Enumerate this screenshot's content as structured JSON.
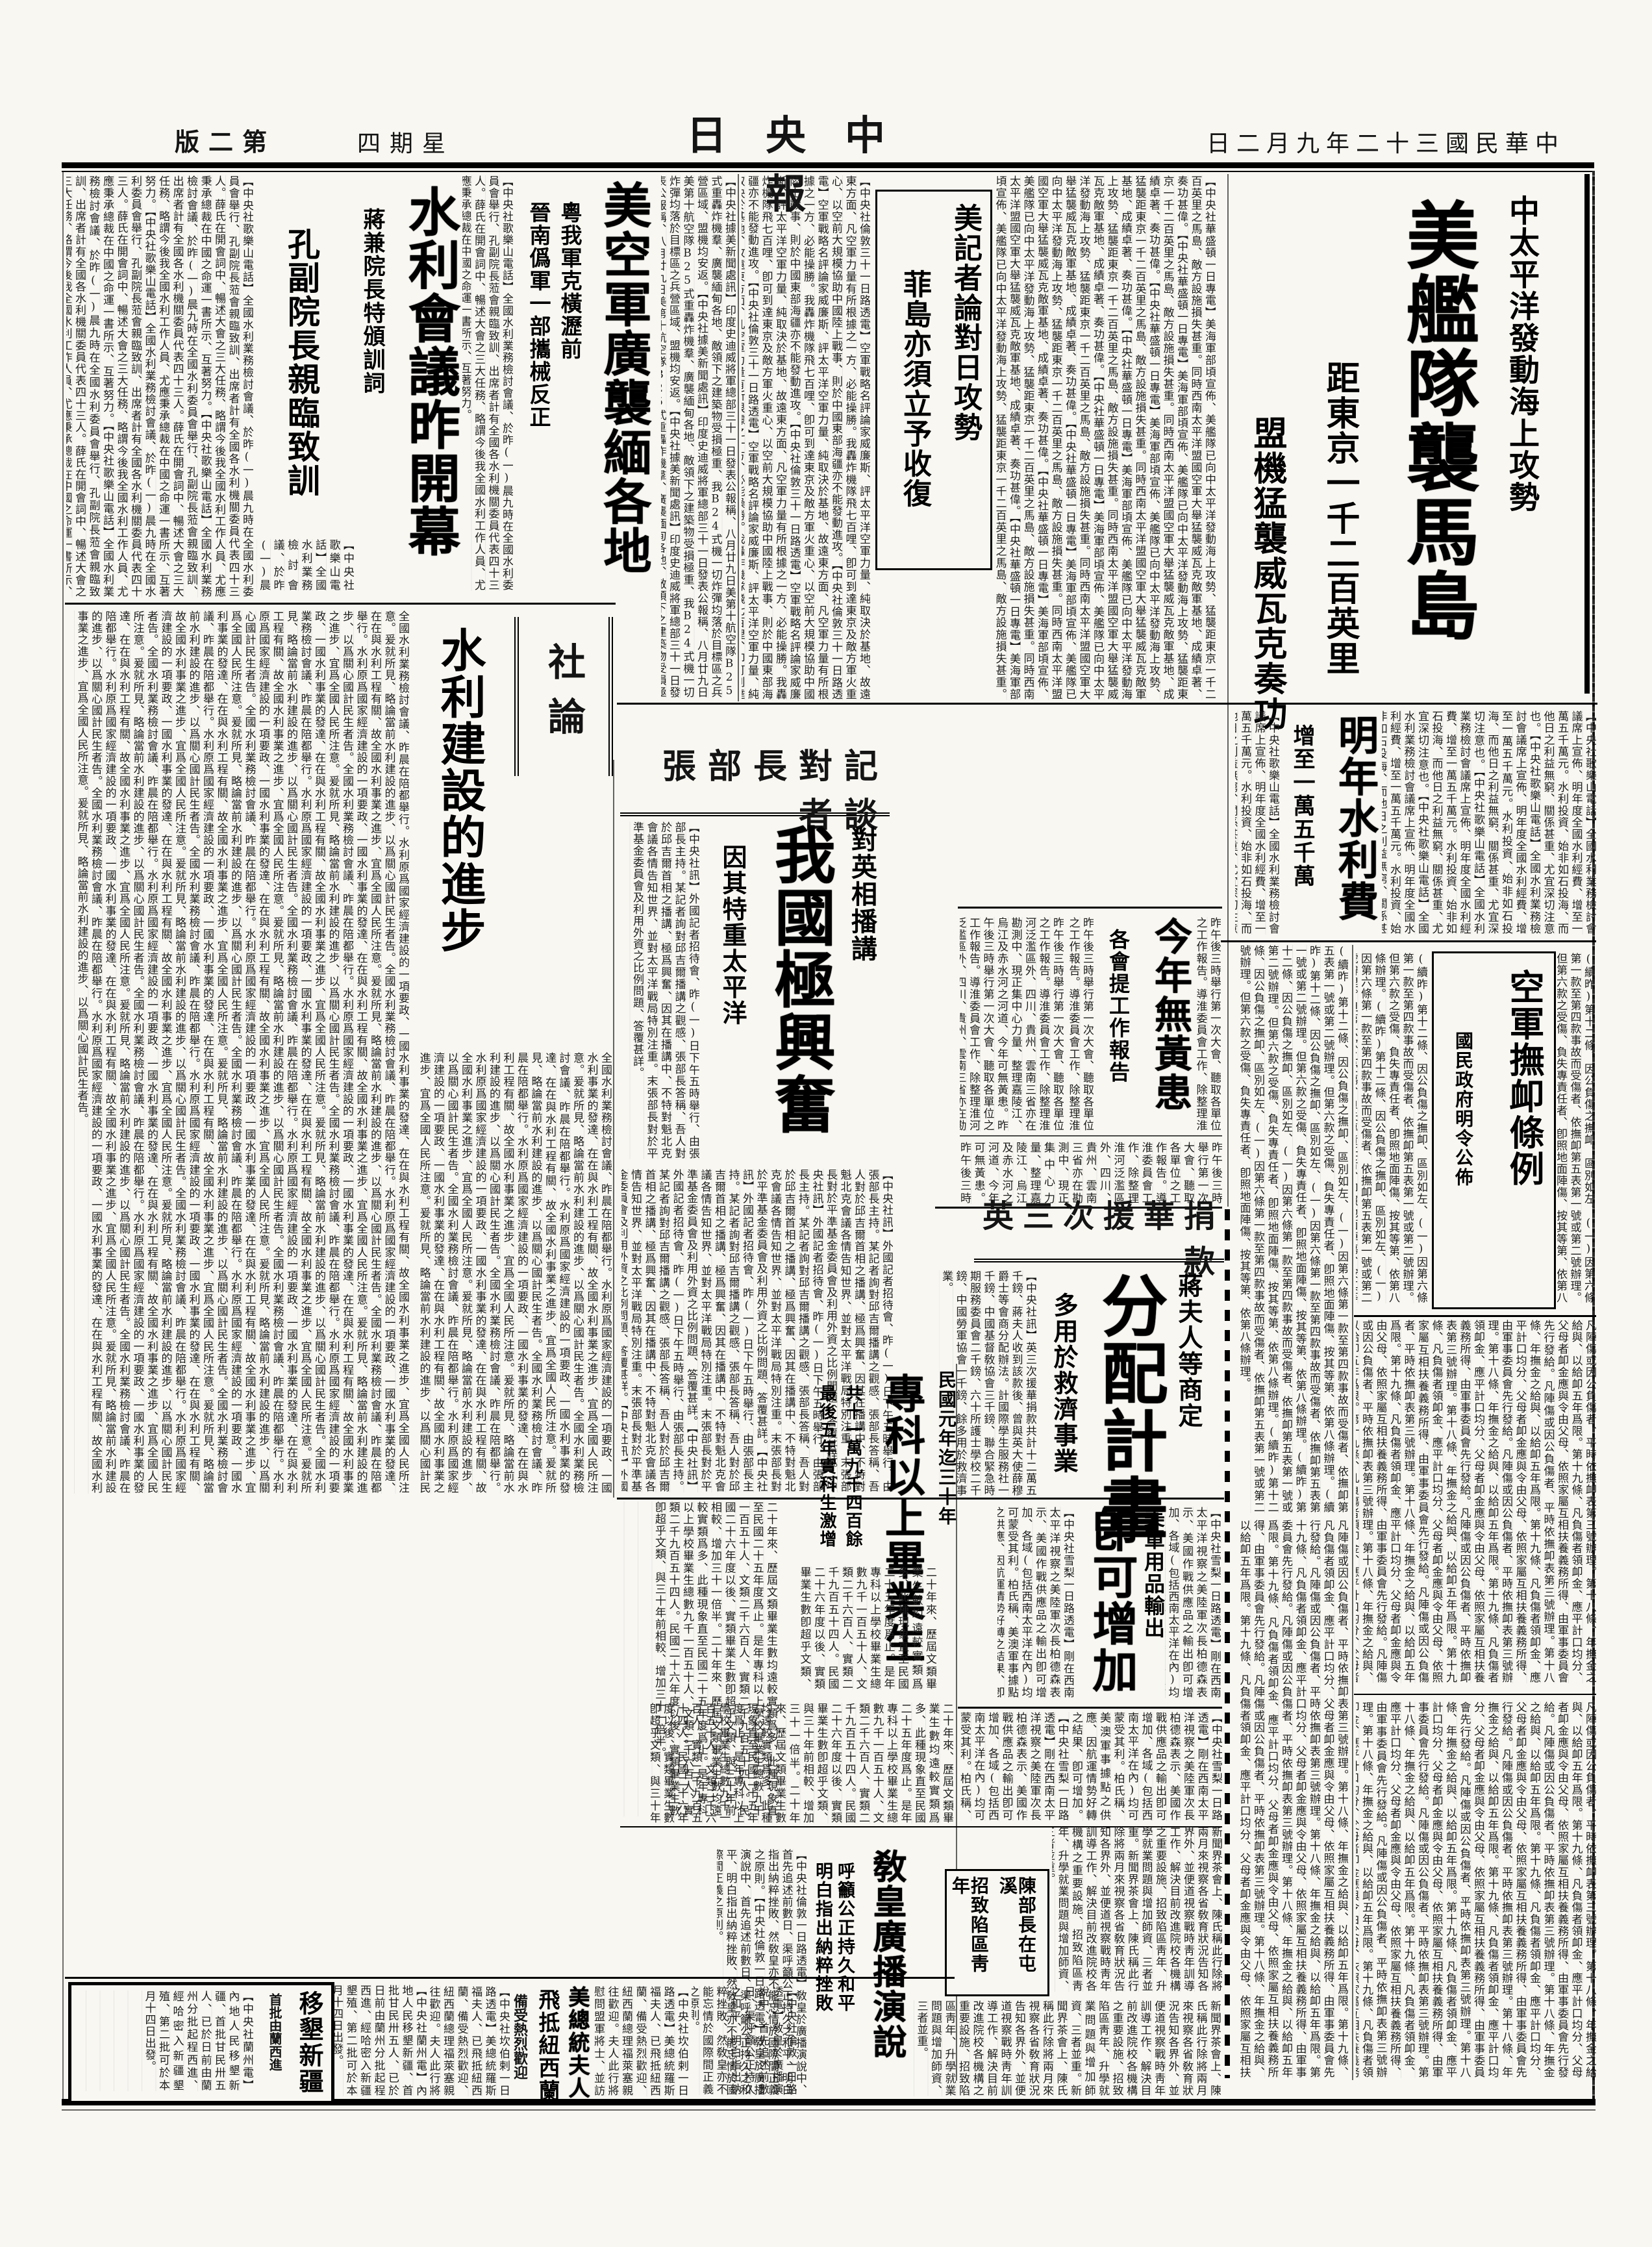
{
  "page": {
    "masthead": "中央日報",
    "date": "中華民國三十二年九月二日",
    "weekday": "星期四",
    "edition": "第二版"
  },
  "articles": {
    "flagship": {
      "kicker": "中太平洋發動海上攻勢",
      "title": "美艦隊襲馬島",
      "deck1": "距東京一千二百英里",
      "deck2": "盟機猛襲威瓦克奏功",
      "lead": "【中央社華盛頓一日專電】美海軍部頃宣佈、美艦隊已向中太平洋發動海上攻勢、猛襲距東京一千二百英里之馬島、敵方設施損失甚重。同時西南太平洋盟國空軍大舉猛襲威瓦克敵軍基地、成績卓著、奏功甚偉。"
    },
    "reporters": {
      "title1": "美記者論對日攻勢",
      "title2": "菲島亦須立予收復",
      "lead": "【中央社倫敦三十一日路透電】空軍戰略名評論家威廉斯、評太平洋空軍力量、純取決於基地、故遠東方面、凡空軍力量有所根據之一方、必能操勝。我轟炸機隊飛七百哩、卽可到達東京及敵方軍火重心、以空前大規模協助中國陸上戰事、則於中國東部海疆亦不能發動進攻。"
    },
    "burma": {
      "title": "美空軍廣襲緬各地",
      "deck1": "粵我軍克橫瀝前",
      "deck2": "晉南僞軍一部攜械反正",
      "lead": "【中央社據美新聞處訊】印度史迪威將軍總部三十一日發表公報稱、八月廿九日美第十航空隊B25式重轟炸機羣、廣襲緬甸各地、敵領下之建築物受損極重、我B24式機一切炸彈均落於目標區之兵營區域、盟機均安返。"
    },
    "waterConf": {
      "title": "水利會議昨開幕",
      "deck1": "蔣兼院長特頒訓詞",
      "deck2": "孔副院長親臨致訓",
      "lead": "【中央社歌樂山電話】全國水利業務檢討會議、於昨(一)晨九時在全國水利委員會舉行、孔副院長蒞會親臨致訓、出席者計有全國各水利機關委員代表四十三人。薛氏在開會詞中、暢述大會之三大任務、略謂今後我全國水利工作人員、尤應秉承總裁在中國之命運一書所示、互著努力。"
    },
    "editorial": {
      "section": "社論",
      "title": "水利建設的進步",
      "lead": "全國水利業務檢討會議、昨晨在陪都舉行。水利原爲國家經濟建設的一項要政、一國水利事業的發達、在在與水利工程有關、故全國水利事業之進步、宜爲全國人民所注意。爰就所見、略論當前水利建設的進步、以爲關心國計民生者告。"
    },
    "chang": {
      "header": "張部長對記者談",
      "kicker": "對英相播講",
      "title": "我國極興奮",
      "deck": "因其特重太平洋",
      "lead": "【中央社訊】外國記者招待會、昨(一)日下午五時舉行、由張部長主持。某記者詢對邱吉爾播講之觀感、張部長答稱、吾人對於邱吉爾首相之播講、極爲興奮、因其在播講中、不特對魁北克會議各情告知世界、並對太平洋戰局特別注重。末張部長對於平準基金委員會及利用外資之比例問題、答覆甚詳。"
    },
    "waterBudget": {
      "title": "明年水利費",
      "deck": "增至一萬五千萬",
      "lead": "【中央社歌樂山電話】全國水利業務檢討會議席上宣佈、明年度全國水利經費、增至一萬五千萬元。水利投資、始非如石投海、而他日之利益無窮、關係甚重、尤宜深切注意也。"
    },
    "pension": {
      "title": "空軍撫卹條例",
      "deck": "國民政府明令公佈",
      "lead": "(續昨)第十二條、因公負傷之撫卹、區別如左、(一)因第六條第一款至第四款事故而受傷者、依撫卹第五表第一號或第二號辦理。但第六款之受傷、負失專責任者、卽照地面陣傷、按其等第、依第八條辦理。",
      "more": "凡陣傷或因公負傷者、平時依撫卹表第三號辦理。第十八條、年撫金之給與、以給卹五年爲限。第十九條、凡負傷者領卹金、應平計口均分、父母者卹金應與令由父母、依照家屬互相扶養義務所得、由軍事委員會先行發給。"
    },
    "noFlood": {
      "title": "今年無黃患",
      "deck": "各會提工作報告",
      "lead": "昨午後三時舉行第一次大會、聽取各單位之工作報告。導淮委員會工作、除整理淮河泛濫區外、四川、貴州、雲南三省亦在勘測中、現正集中心力量、整理嘉陵江、烏江及赤水河之河道、今年可無黃患。"
    },
    "donation": {
      "header": "英三次援華捐款",
      "kicker": "蔣夫人等商定",
      "title": "分配計畫",
      "deck": "多用於救濟事業",
      "lead": "【中央社訊】英三次援華捐款共計十二萬五千鎊、蔣夫人收到該款後、曾與英大使薛穆爵士等會商分配辦法。計國際學生服務社一千鎊、中國基督敎協會三千鎊、聯合緊急時期服務委員會二千鎊、六十所護士學校二千鎊、中國勞軍協會一千鎊、餘多用於救濟事業。"
    },
    "graduates": {
      "kicker": "民國元年迄三十年",
      "title": "專科以上畢業生",
      "deck1": "共十一萬九千四百餘",
      "deck2": "最後五年實科生激增",
      "lead": "二十年來、歷屆文類畢業生數均遠較實類爲多、此種現象直至民國二十五年度爲止。是年專科以上學校畢業生總數九千一百五十人、文類二千六百人、實類二千九百五十四人。民國二十六年度以後、實類畢業生數卽超乎文類、與三十年前相較、增加三十一倍半。"
    },
    "exports": {
      "kicker": "美軍用品輸出",
      "title": "卽可增加",
      "lead": "【中央社雪梨一日路透電】剛在西南太平洋視察之美陸軍次長柏德森表示、美國作戰供應品之輸出卽可增加、各域(包括西南太平洋在內)均可蒙受其利。柏氏稱、美澳軍事據點之供應、因航運情勢好轉之結果、卽可增加。"
    },
    "pope": {
      "title": "敎皇廣播演說",
      "deck1": "呼籲公正持久和平",
      "deck2": "明白指出納粹挫敗",
      "lead": "【中央社倫敦一日路透電】敎皇於廣播演說中、首先追述前數日、渠呼籲公正持久之和平、明白指出納粹挫敗、然敎皇亦不能忘情於國際間正義之原則。"
    },
    "chen": {
      "line1": "陳部長在屯溪",
      "line2": "招致陷區靑年",
      "lead": "新聞界茶會上、陳氏稱此行除將兩月來視察各省敎育狀況告知各界外、並便道視察戰時靑年訓導工作、解決目前改進院校各機構之重要設施、招致陷區靑年、升學就業問題與增加師資、三者並重。"
    },
    "firstLady": {
      "title": "美總統夫人",
      "title2": "飛抵紐西蘭",
      "deck": "備受熱烈歡迎",
      "lead": "【中央社坎伯剌一日路透電】美總統羅斯福夫人、已飛抵紐西蘭、備受熱烈歡迎、紐西蘭總理福萊塞親往歡迎。夫人此行將慰問盟軍將士、並訪問澳洲、澳政府與人民竭誠接待、歡迎之熱烈空前。"
    },
    "migration": {
      "title": "移墾新疆",
      "deck": "首批由蘭西進",
      "lead": "【中央社蘭州電】內地人民移墾新疆、首批甘民卅五人、已於日前由蘭州分批起程西進、經哈密入新疆墾殖、第二批可於本月十四日出發。"
    }
  }
}
